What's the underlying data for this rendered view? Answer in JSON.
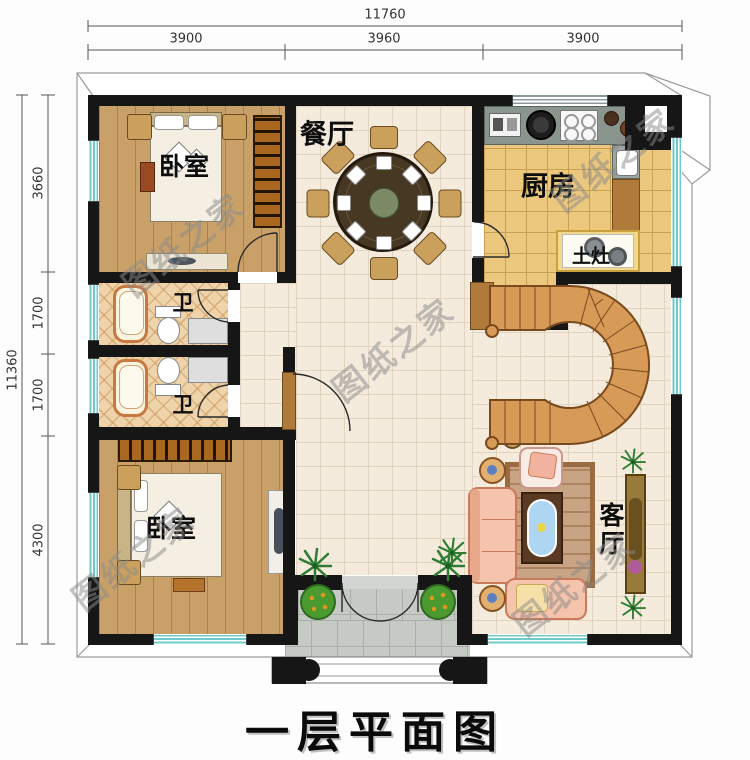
{
  "title": "一层平面图",
  "watermark": {
    "text": "图纸之家"
  },
  "dimensions": {
    "top": {
      "total": "11760",
      "segments": [
        "3900",
        "3960",
        "3900"
      ]
    },
    "left": {
      "total": "11360",
      "segments": [
        "3660",
        "1700",
        "1700",
        "4300"
      ]
    }
  },
  "rooms": {
    "bedroom_top": {
      "label": "卧室"
    },
    "bedroom_bottom": {
      "label": "卧室"
    },
    "dining": {
      "label": "餐厅"
    },
    "kitchen": {
      "label": "厨房"
    },
    "stove": {
      "label": "土灶"
    },
    "bath_top": {
      "label": "卫"
    },
    "bath_bottom": {
      "label": "卫"
    },
    "living": {
      "label": "客厅"
    }
  },
  "colors": {
    "wall": "#161616",
    "window_stripe": "#6fc9c9",
    "wood_floor": "#c9a168",
    "kitchen_tile": "#ecc87f",
    "hall_tile": "#f4ebdd",
    "stair_wood": "#d79b57",
    "sofa": "#f6c4ac",
    "watermark_gray": "#8a8a8a"
  }
}
